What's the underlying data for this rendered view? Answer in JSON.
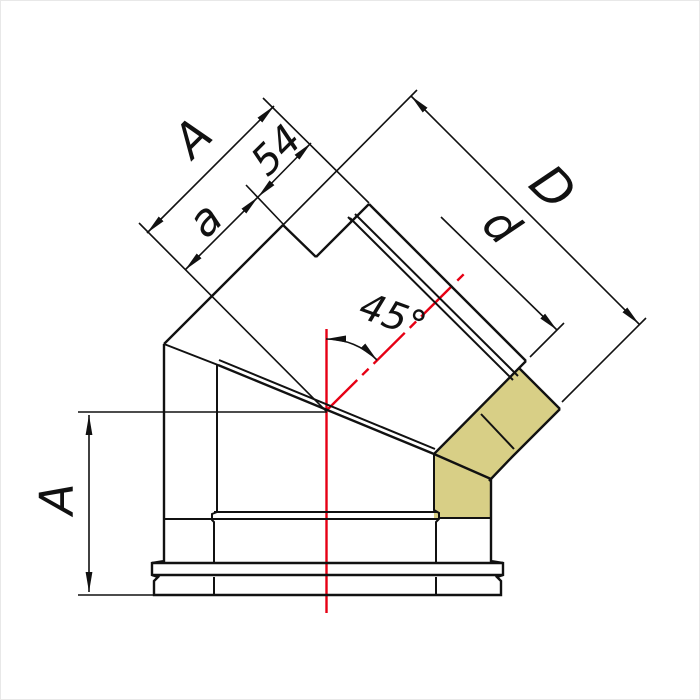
{
  "drawing": {
    "type": "technical-drawing",
    "subject": "45-degree double-wall insulated chimney elbow, half-section view",
    "angle_label": "45°",
    "dimensions": {
      "side_height_label": "A",
      "branch_total_label": "A",
      "branch_effective_label": "a",
      "insertion_depth_label": "54",
      "outer_diameter_label": "D",
      "inner_diameter_label": "d"
    },
    "colors": {
      "line": "#111111",
      "centerline_red": "#e60014",
      "insulation_yellow": "#d8cf86",
      "background": "#ffffff"
    }
  }
}
